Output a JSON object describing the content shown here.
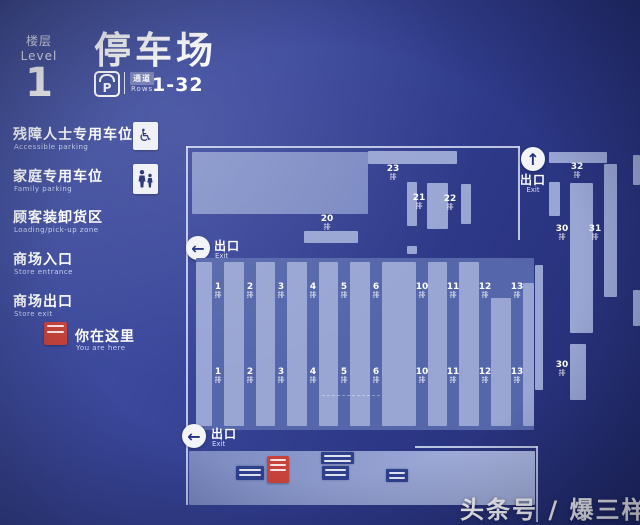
{
  "header": {
    "floor_label_zh": "楼层",
    "floor_label_en": "Level",
    "floor_number": "1",
    "title": "停车场",
    "parking_symbol": "P",
    "aisle_zh": "通道",
    "aisle_en": "Rows",
    "aisle_range": "1-32"
  },
  "legend": {
    "items": [
      {
        "zh": "残障人士专用车位",
        "en": "Accessible parking",
        "icon": "wheelchair-icon"
      },
      {
        "zh": "家庭专用车位",
        "en": "Family parking",
        "icon": "family-icon"
      },
      {
        "zh": "顾客装卸货区",
        "en": "Loading/pick-up zone",
        "icon": ""
      },
      {
        "zh": "商场入口",
        "en": "Store entrance",
        "icon": ""
      },
      {
        "zh": "商场出口",
        "en": "Store exit",
        "icon": ""
      },
      {
        "zh": "你在这里",
        "en": "You are here",
        "icon": "you-are-here-marker"
      }
    ]
  },
  "map": {
    "exit_zh": "出口",
    "exit_en": "Exit",
    "row_suffix": "排",
    "grid_labels": [
      "1",
      "2",
      "3",
      "4",
      "5",
      "6",
      "10",
      "11",
      "12",
      "13"
    ],
    "side_labels": {
      "r20": "20",
      "r21": "21",
      "r22": "22",
      "r23": "23",
      "r30": "30",
      "r31": "31",
      "r32": "32",
      "r30b": "30"
    }
  },
  "icons": {
    "up_arrow": "↑",
    "left_arrow": "←",
    "wheelchair": "♿"
  },
  "watermark": "头条号 / 爆三样",
  "colors": {
    "background": "#33409b",
    "panel": "#5566ab",
    "bar": "#99a5d3",
    "accent_red": "#c6423a",
    "white": "#f5f6fa"
  }
}
